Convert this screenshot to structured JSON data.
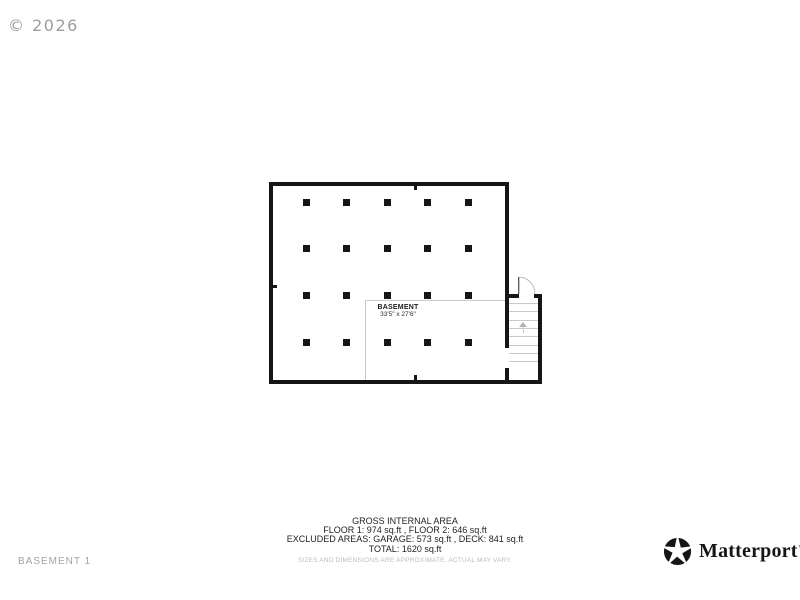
{
  "watermark": "© 2026",
  "page_label": "BASEMENT 1",
  "floor_plan": {
    "room": {
      "name": "BASEMENT",
      "dimensions": "33'5\" x 27'6\""
    },
    "posts_grid": {
      "cols": 5,
      "rows": 4
    },
    "stairs": {
      "treads": 8,
      "direction_icon": "up-arrow"
    },
    "door_icon": "door-swing"
  },
  "area_summary": {
    "title": "GROSS INTERNAL AREA",
    "floors_line": "FLOOR 1: 974 sq.ft , FLOOR 2: 646 sq.ft",
    "excluded_line": "EXCLUDED AREAS: GARAGE: 573 sq.ft , DECK: 841 sq.ft",
    "total_line": "TOTAL: 1620 sq.ft",
    "disclaimer": "SIZES AND DIMENSIONS ARE APPROXIMATE, ACTUAL MAY VARY."
  },
  "branding": {
    "logo_text": "Matterport",
    "trademark": "™"
  },
  "colors": {
    "wall": "#161616",
    "accent_gray": "#c9c9c9",
    "muted_text": "#a3a3a3"
  }
}
